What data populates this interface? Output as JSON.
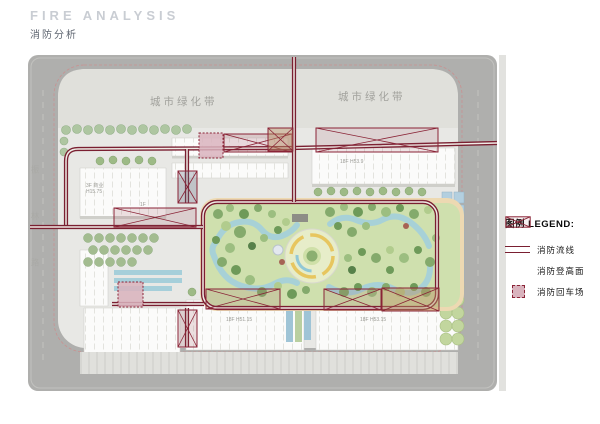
{
  "header": {
    "title_en": "FIRE ANALYSIS",
    "title_zh": "消防分析"
  },
  "plan": {
    "green_belt_left": "城市绿化带",
    "green_belt_right": "城市绿化带",
    "road_name_left": "振林路",
    "building_labels": {
      "upper_right": "18F H53.9",
      "lower_mid": "18F H51.15",
      "lower_right": "18F H53.15",
      "commercial_line1": "3F 商业",
      "commercial_line2": "H15.75",
      "commercial_floor": "1F"
    }
  },
  "legend": {
    "title": "图例 LEGEND:",
    "items": [
      {
        "symbol": "fire-route-double-line",
        "label": "消防流线"
      },
      {
        "symbol": "fire-ladder-crossed-box",
        "label": "消防登高面"
      },
      {
        "symbol": "fire-turnaround-dotted-square",
        "label": "消防回车场"
      }
    ]
  },
  "colors": {
    "fire_route": "#7a1f31",
    "crossed_box_stroke": "#8a2336",
    "turnaround_fill": "#d9b3bd",
    "road": "#afafad",
    "site_bg": "#e8e8e5",
    "green_belt": "#e0e0db",
    "park_green": "#cfe0ae",
    "park_edge": "#edd9b2",
    "water": "#a4d0db",
    "title_gray": "#c9cdd3"
  }
}
